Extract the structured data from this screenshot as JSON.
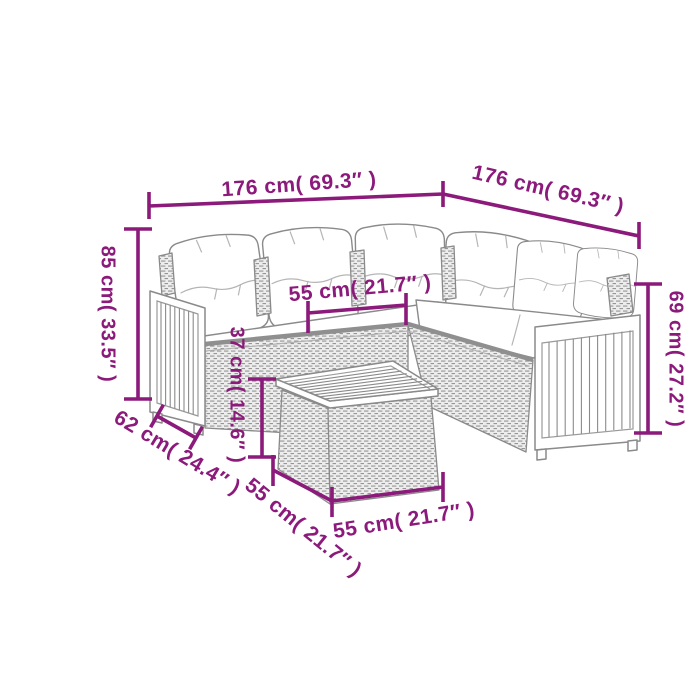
{
  "illustration": {
    "subject": "rattan-corner-sofa-set-with-cushions-and-coffee-table",
    "style": "line-drawing-dimension-diagram"
  },
  "colors": {
    "dimension_accent": "#8B1A7B",
    "sketch_line": "#8A8A8A"
  },
  "dimension_labels": {
    "top_left": "176 cm( 69.3″ )",
    "top_right": "176 cm( 69.3″ )",
    "height_left": "85 cm( 33.5″ )",
    "height_right": "69 cm( 27.2″ )",
    "seat_width": "55 cm( 21.7″ )",
    "table_height": "37 cm( 14.6″ )",
    "seat_depth": "62 cm( 24.4″ )",
    "table_depth": "55 cm( 21.7″ )",
    "table_width": "55 cm( 21.7″ )"
  }
}
